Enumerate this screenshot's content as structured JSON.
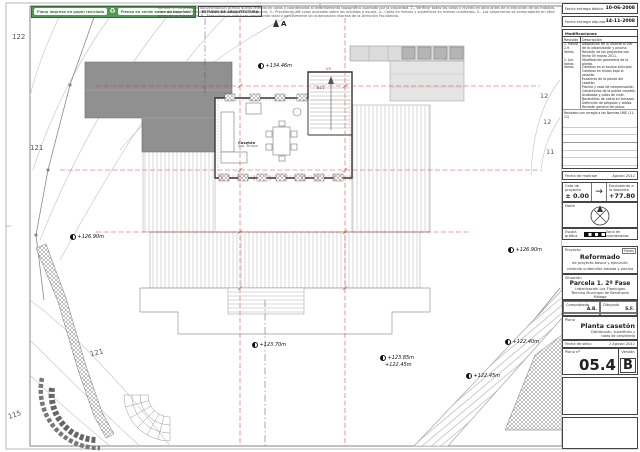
{
  "banner": {
    "eco_label_1": "Plano impreso en papel reciclado",
    "eco_label_2": "Piensa en verde antes de imprimir",
    "recycle_icon": "♻",
    "firm": "ESTUDIO DE ARQUITECTURA",
    "disclaimer_1": "NOTAS: 1.- La presente documentación gráfica queda referida en cotas y coordenadas al levantamiento topográfico aportado por la propiedad. 2.- Verificar todas las cotas y niveles en obra antes de la ejecución de los trabajos, comunicando a la Dirección Facultativa cualquier discrepancia. 3.- Prevalecen las cotas acotadas sobre las medidas a escala.",
    "disclaimer_2": "4.- Cotas en metros y superficies en metros cuadrados. 5.- Las carpinterías se comprobarán en obra antes de su fabricación. 6.- Este plano no podrá ser reproducido total o parcialmente sin autorización expresa de la Dirección Facultativa."
  },
  "titleblock": {
    "fecha_basico_label": "Fecha entrega básico",
    "fecha_basico_value": "10-06-2008",
    "fecha_adjunto_label": "Fecha entrega adjunto",
    "fecha_adjunto_value": "14-11-2008",
    "modificaciones": {
      "title": "Modificaciones",
      "col_rev": "Revisión",
      "col_desc": "Descripción",
      "rows": [
        {
          "rev": "1. Marzo 2.9",
          "desc": "Adaptación de la rasante al vial de la urbanización y piscina."
        },
        {
          "rev": "Varios",
          "desc": "Revisión de los proyectos con fecha 05 marzo 2011."
        },
        {
          "rev": "2. Jun. Varios",
          "desc": "Modificación geometría de la planta."
        },
        {
          "rev": "Varios",
          "desc": "Cambios en el acceso principal."
        },
        {
          "rev": "",
          "desc": "Cambios en muros bajo la rasante."
        },
        {
          "rev": "",
          "desc": "Escaleras de la planta del casetón."
        },
        {
          "rev": "",
          "desc": "Piscina y vaso de compensación."
        },
        {
          "rev": "",
          "desc": "Carpinterías de la planta casetón."
        },
        {
          "rev": "",
          "desc": "Acabados y cotas de nivel."
        },
        {
          "rev": "",
          "desc": "Barandillas de vidrio en terrazas."
        },
        {
          "rev": "",
          "desc": "Definición de pérgolas y toldos."
        },
        {
          "rev": "",
          "desc": "Revisión general del plano."
        }
      ],
      "note": "Revisado con arreglo a las Normas UNE (11-11)"
    },
    "fecha_montaje_label": "Fecha de montaje",
    "fecha_montaje_value": "Agosto 2011",
    "cota_label": "Cota de proyecto",
    "cota_value": "± 0.00",
    "arrow": "→",
    "elev_label": "Equivalente a la absoluta",
    "elev_value": "+77.80",
    "norte_label": "Norte",
    "escala_label": "Escala gráfica",
    "zona_label": "Zona en coordenadas",
    "proyecto_label": "Proyecto",
    "fases_label": "Fases",
    "proyecto_line1": "Reformado",
    "proyecto_line2": "de proyecto básico y ejecución",
    "proyecto_line3": "vivienda unifamiliar aislada y piscina",
    "situacion_label": "Situación",
    "situacion_line1": "Parcela 1. 2ª Fase",
    "situacion_line2": "Urbanización Los Flamingos",
    "situacion_line3": "Término Municipal de Benahavís",
    "situacion_line4": "Málaga",
    "comprobado_label": "Comprobado",
    "comprobado_value": "A.B.",
    "dibujado_label": "Dibujado",
    "dibujado_value": "S.F.",
    "proyecto_num_label": "Proyecto nº",
    "proyecto_num_value": "5/3/06",
    "escala_plano_label": "Escala",
    "escala_plano_value": "A1 1/100",
    "plano_label": "Plano",
    "plano_title": "Planta casetón",
    "plano_sub1": "Distribución, superficies y",
    "plano_sub2": "cotas de carpintería",
    "fecha_sello_label": "Fecha de sello:",
    "fecha_sello_value": "1 Agosto 2011",
    "plano_num_label": "Plano nº",
    "plano_num_value": "05.4",
    "version_label": "Versión",
    "version_value": "B"
  },
  "plan": {
    "section_marker": "A",
    "stair_label": "B11",
    "window_tag": "V5",
    "room_label": "Casetón",
    "room_sub": "Sup. Terraza",
    "elevations": [
      {
        "text": "+134.46m"
      },
      {
        "text": "+126.90m"
      },
      {
        "text": "+126.90m"
      },
      {
        "text": "+123.70m"
      },
      {
        "text": "+123.85m"
      },
      {
        "text": "+122.45m"
      },
      {
        "text": "+122.45m"
      },
      {
        "text": "+122.40m"
      }
    ],
    "contours": [
      {
        "text": "122"
      },
      {
        "text": "121"
      },
      {
        "text": "121"
      },
      {
        "text": "115"
      },
      {
        "text": "12"
      },
      {
        "text": "12"
      },
      {
        "text": "11"
      }
    ]
  },
  "colors": {
    "accent_red": "#c0392b",
    "banner_green": "#4e9a4e",
    "roof_gray": "#909090"
  }
}
